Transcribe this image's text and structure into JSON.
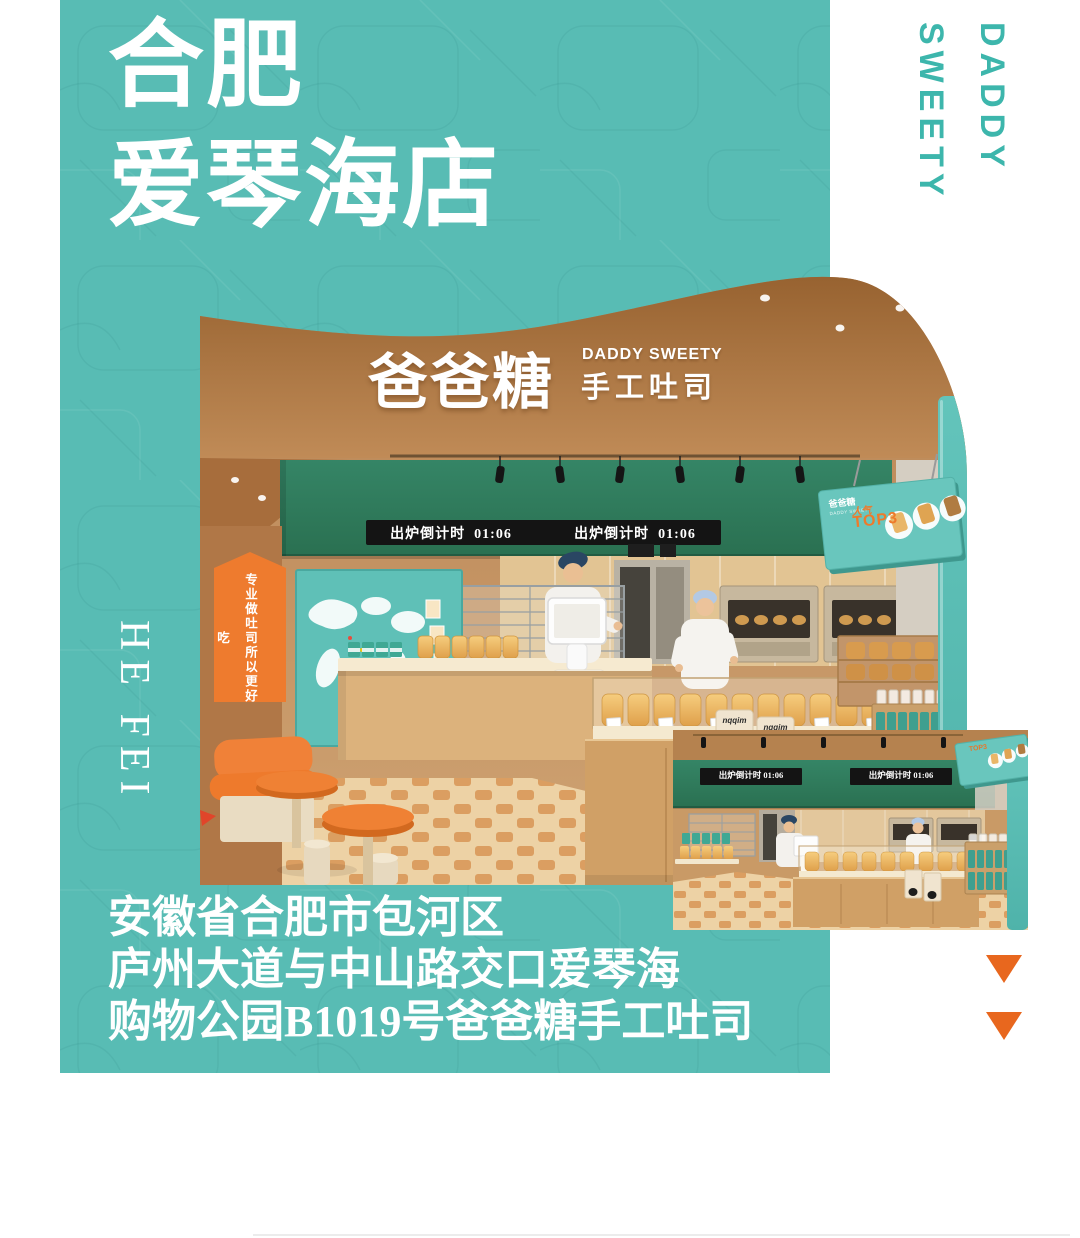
{
  "poster": {
    "title": {
      "line1": "合肥",
      "line2": "爱琴海店"
    },
    "brand_vertical": {
      "line1": "DADDY",
      "line2": "SWEETY"
    },
    "city_vertical": "HE FEI",
    "address": {
      "line1": "安徽省合肥市包河区",
      "line2": "庐州大道与中山路交口爱琴海",
      "line3": "购物公园B1019号爸爸糖手工吐司"
    }
  },
  "storefront": {
    "sign": {
      "cn": "爸爸糖",
      "en": "DADDY SWEETY",
      "sub": "手工吐司"
    },
    "led_text": "出炉倒计时  01:06",
    "banner_vertical": "专业做吐司所以更好吃",
    "hanging_sign": {
      "brand": "爸爸糖",
      "brand_sub": "DADDY SWEETY",
      "label": "人气",
      "top3": "TOP3"
    },
    "flour_bag_label": "nqqim"
  },
  "inset": {
    "led_text": "出炉倒计时 01:06"
  },
  "colors": {
    "teal_background": "#58bcb4",
    "brand_teal_text": "#3db6ac",
    "storefront_green": "#2f8160",
    "accent_orange": "#ee7b2e",
    "triangle_orange": "#e8671e",
    "wood_brown": "#bd8a57",
    "led_background": "#141414",
    "text_white": "#ffffff"
  }
}
